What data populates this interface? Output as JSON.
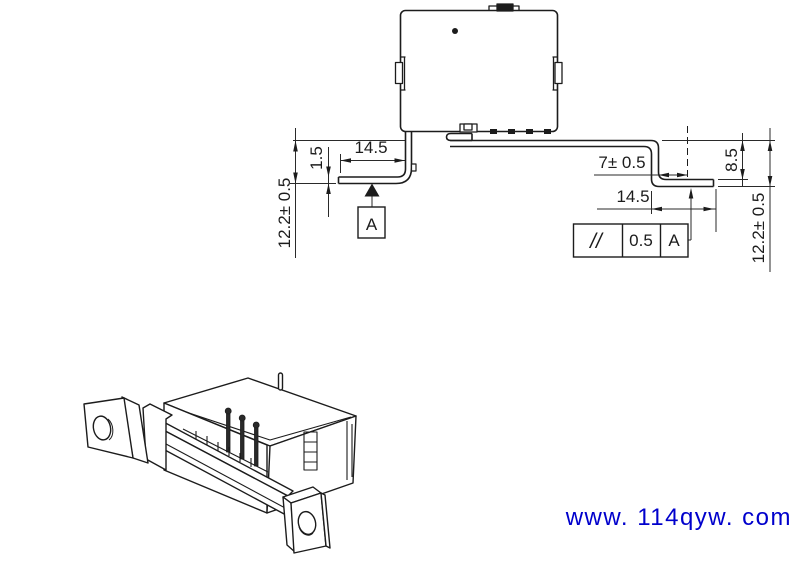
{
  "front_view": {
    "dim_left_height": "12.2± 0.5",
    "dim_lead_thickness": "1.5",
    "dim_left_span": "14.5",
    "datum_label": "A",
    "dim_right_offset": "7± 0.5",
    "dim_right_span": "14.5",
    "dim_step_height": "8.5",
    "dim_right_height": "12.2± 0.5",
    "tolerance_frame": {
      "symbol": "//",
      "value": "0.5",
      "datum": "A"
    }
  },
  "watermark": {
    "text": "www. 114qyw. com",
    "color": "#0000cc"
  }
}
